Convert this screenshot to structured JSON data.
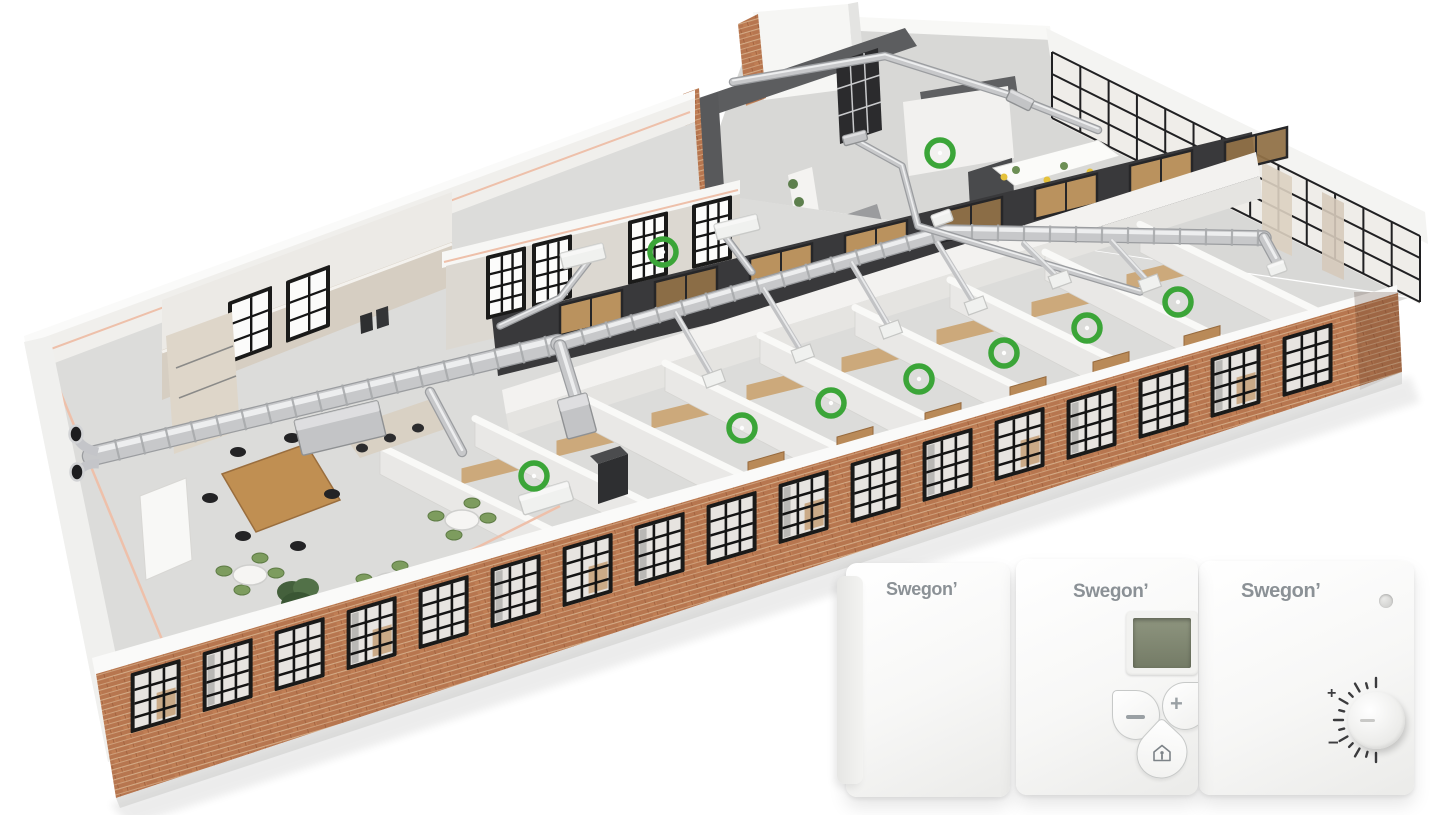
{
  "colors": {
    "marker_green": "#3BA538",
    "brick": "#B7764F",
    "mortar": "#D8B18C",
    "duct_silver": "#C7C8CA",
    "duct_highlight": "#EDEEEF",
    "duct_shadow": "#9B9DA0",
    "floor_gray": "#DCDCDA",
    "wall_white": "#F1F0EE",
    "wall_dark": "#5C5D5F",
    "wood": "#C79C63",
    "accent_pipe": "#EEC0AA",
    "logo_gray": "#8B9196",
    "lcd_green": "#848B76"
  },
  "scene": {
    "markers": {
      "color": "#3BA538",
      "radius": 13,
      "stroke": 5.5,
      "points": [
        [
          940,
          153
        ],
        [
          663,
          252
        ],
        [
          1178,
          302
        ],
        [
          1087,
          328
        ],
        [
          1004,
          353
        ],
        [
          919,
          379
        ],
        [
          831,
          403
        ],
        [
          742,
          428
        ],
        [
          534,
          476
        ]
      ]
    },
    "facade_windows": {
      "start": [
        98,
        672
      ],
      "end": [
        1396,
        293
      ],
      "count": 17,
      "lead": 34,
      "width": 50,
      "gap": 25,
      "height": 60,
      "top_offset": 11
    },
    "kitchen_windows": {
      "skew": -20.4,
      "width": 44,
      "height": 62,
      "cols": 2,
      "rows": 3,
      "pane": "#fbfbfa",
      "origins": [
        [
          228,
          302
        ],
        [
          286,
          281
        ]
      ]
    },
    "back_windows": {
      "skew": -13.8,
      "width": 40,
      "height": 64,
      "cols": 3,
      "rows": 4,
      "pane": "#fcfcfb",
      "origins": [
        [
          486,
          256
        ],
        [
          532,
          244
        ],
        [
          628,
          221
        ],
        [
          692,
          205
        ]
      ]
    },
    "partitions": {
      "x0": 98,
      "y0": 672,
      "slope": -0.292,
      "xs": [
        556,
        651,
        746,
        841,
        936,
        1031,
        1126,
        1221,
        1316
      ],
      "back_dx": -176,
      "back_dy": -86,
      "lift": 6,
      "face_h": 28
    },
    "trunks": [
      {
        "pts": [
          [
            92,
            456
          ],
          [
            558,
            344
          ]
        ],
        "w": 18,
        "c": true
      },
      {
        "pts": [
          [
            558,
            344
          ],
          [
            946,
            232
          ],
          [
            1264,
            238
          ]
        ],
        "w": 13,
        "c": true
      },
      {
        "pts": [
          [
            560,
            346
          ],
          [
            576,
            398
          ]
        ],
        "w": 11,
        "c": false
      },
      {
        "pts": [
          [
            430,
            392
          ],
          [
            462,
            452
          ]
        ],
        "w": 8,
        "c": false
      },
      {
        "pts": [
          [
            1264,
            238
          ],
          [
            1276,
            260
          ]
        ],
        "w": 9,
        "c": false
      },
      {
        "pts": [
          [
            733,
            82
          ],
          [
            885,
            56
          ],
          [
            1012,
            96
          ],
          [
            1098,
            130
          ]
        ],
        "w": 6,
        "c": false
      },
      {
        "pts": [
          [
            855,
            140
          ],
          [
            902,
            166
          ],
          [
            918,
            226
          ],
          [
            1140,
            292
          ]
        ],
        "w": 5,
        "c": false
      },
      {
        "pts": [
          [
            588,
            262
          ],
          [
            560,
            298
          ],
          [
            500,
            326
          ]
        ],
        "w": 5,
        "c": false
      },
      {
        "pts": [
          [
            722,
            232
          ],
          [
            752,
            272
          ]
        ],
        "w": 5,
        "c": false
      }
    ],
    "branches": [
      [
        [
          1112,
          242
        ],
        [
          1150,
          284
        ]
      ],
      [
        [
          1024,
          244
        ],
        [
          1060,
          280
        ]
      ],
      [
        [
          938,
          244
        ],
        [
          976,
          306
        ]
      ],
      [
        [
          852,
          264
        ],
        [
          891,
          330
        ]
      ],
      [
        [
          764,
          290
        ],
        [
          803,
          354
        ]
      ],
      [
        [
          676,
          314
        ],
        [
          714,
          379
        ]
      ]
    ],
    "unit_boxes": [
      {
        "x": 340,
        "y": 428,
        "w": 86,
        "h": 36,
        "r": -13.5,
        "k": "silver"
      },
      {
        "x": 577,
        "y": 416,
        "w": 30,
        "h": 40,
        "r": -15,
        "k": "silver"
      },
      {
        "x": 583,
        "y": 256,
        "w": 44,
        "h": 16,
        "r": -14,
        "k": "white"
      },
      {
        "x": 737,
        "y": 227,
        "w": 44,
        "h": 16,
        "r": -14,
        "k": "white"
      },
      {
        "x": 546,
        "y": 498,
        "w": 52,
        "h": 20,
        "r": -17,
        "k": "white"
      },
      {
        "x": 1020,
        "y": 100,
        "w": 26,
        "h": 12,
        "r": 26,
        "k": "silver"
      },
      {
        "x": 855,
        "y": 138,
        "w": 24,
        "h": 10,
        "r": -15,
        "k": "silver"
      },
      {
        "x": 942,
        "y": 218,
        "w": 20,
        "h": 12,
        "r": -20,
        "k": "white"
      },
      {
        "x": 1277,
        "y": 268,
        "w": 18,
        "h": 12,
        "r": -20,
        "k": "white"
      }
    ],
    "curtain_wall": {
      "from": [
        1052,
        52
      ],
      "to": [
        1420,
        236
      ],
      "drop": 66,
      "cols": 13,
      "rows": [
        22,
        44
      ]
    },
    "wood_slots": {
      "xs": [
        560,
        655,
        750,
        845,
        940,
        1035,
        1130,
        1225
      ],
      "base": 318,
      "x0": 492,
      "slope": -0.245,
      "skew": -13.8,
      "w": 62,
      "h": 30
    },
    "tables": {
      "centers": [
        [
          250,
          575
        ],
        [
          390,
          583
        ],
        [
          305,
          665
        ],
        [
          462,
          520
        ]
      ],
      "rx": 17,
      "ry": 10,
      "chair_offsets": [
        [
          -26,
          -4
        ],
        [
          26,
          -2
        ],
        [
          -8,
          15
        ],
        [
          10,
          -17
        ]
      ]
    },
    "room_desk_marker_indices": [
      2,
      3,
      4,
      5,
      6,
      7
    ]
  },
  "devices": {
    "logo_color": "#8B9196",
    "items": [
      {
        "id": "controller-basic",
        "logo": "Swegon’"
      },
      {
        "id": "controller-display",
        "logo": "Swegon’",
        "has_lcd": true,
        "buttons": [
          "minus",
          "plus",
          "occupancy"
        ],
        "plus_label": "+"
      },
      {
        "id": "controller-dial",
        "logo": "Swegon’",
        "ticks": 13,
        "plus_label": "+",
        "minus_label": "–",
        "sensor_dot": true
      }
    ]
  }
}
